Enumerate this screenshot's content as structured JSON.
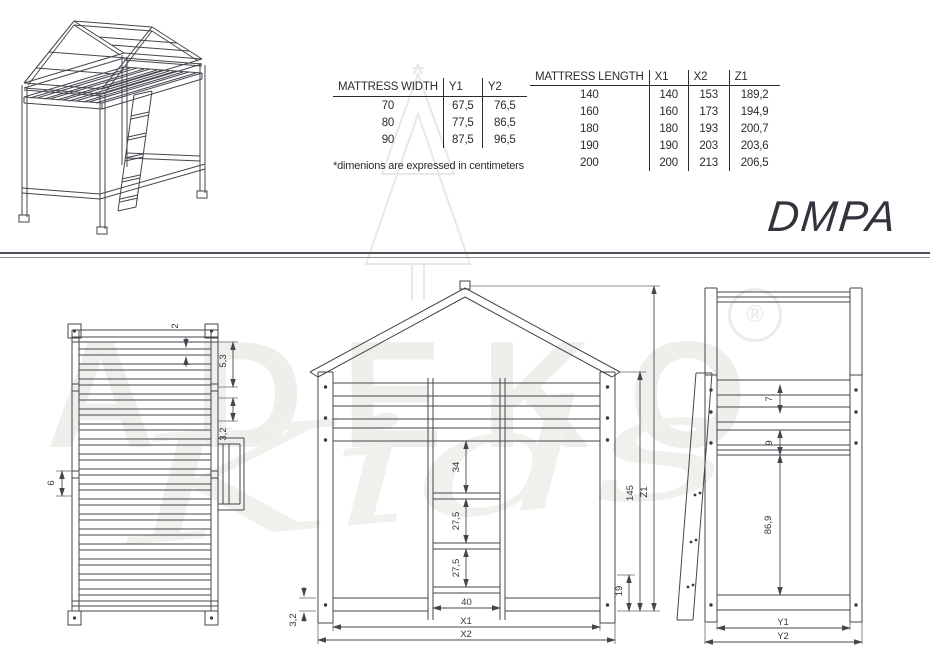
{
  "title": "DMPA",
  "note": "*dimenions are expressed in centimeters",
  "width_table": {
    "headers": [
      "MATTRESS WIDTH",
      "Y1",
      "Y2"
    ],
    "rows": [
      [
        "70",
        "67,5",
        "76,5"
      ],
      [
        "80",
        "77,5",
        "86,5"
      ],
      [
        "90",
        "87,5",
        "96,5"
      ]
    ]
  },
  "length_table": {
    "headers": [
      "MATTRESS LENGTH",
      "X1",
      "X2",
      "Z1"
    ],
    "rows": [
      [
        "140",
        "140",
        "153",
        "189,2"
      ],
      [
        "160",
        "160",
        "173",
        "194,9"
      ],
      [
        "180",
        "180",
        "193",
        "200,7"
      ],
      [
        "190",
        "190",
        "203",
        "203,6"
      ],
      [
        "200",
        "200",
        "213",
        "206,5"
      ]
    ]
  },
  "watermark": {
    "brand": "ADEKO",
    "reg": "®",
    "script": "Kids"
  },
  "dims": {
    "front_view": {
      "d34": "34",
      "d275a": "27,5",
      "d275b": "27,5",
      "d40": "40",
      "x1": "X1",
      "x2": "X2",
      "d32": "3,2",
      "d19": "19",
      "d145": "145",
      "z1": "Z1"
    },
    "side_view": {
      "d7": "7",
      "d9": "9",
      "d869": "86,9",
      "y1": "Y1",
      "y2": "Y2"
    },
    "top_view": {
      "d2": "2",
      "d53": "5,3",
      "d32": "3,2",
      "d6": "6"
    }
  },
  "colors": {
    "line": "#45454d",
    "text": "#2b2b33",
    "watermark": "#eeeeeb"
  }
}
